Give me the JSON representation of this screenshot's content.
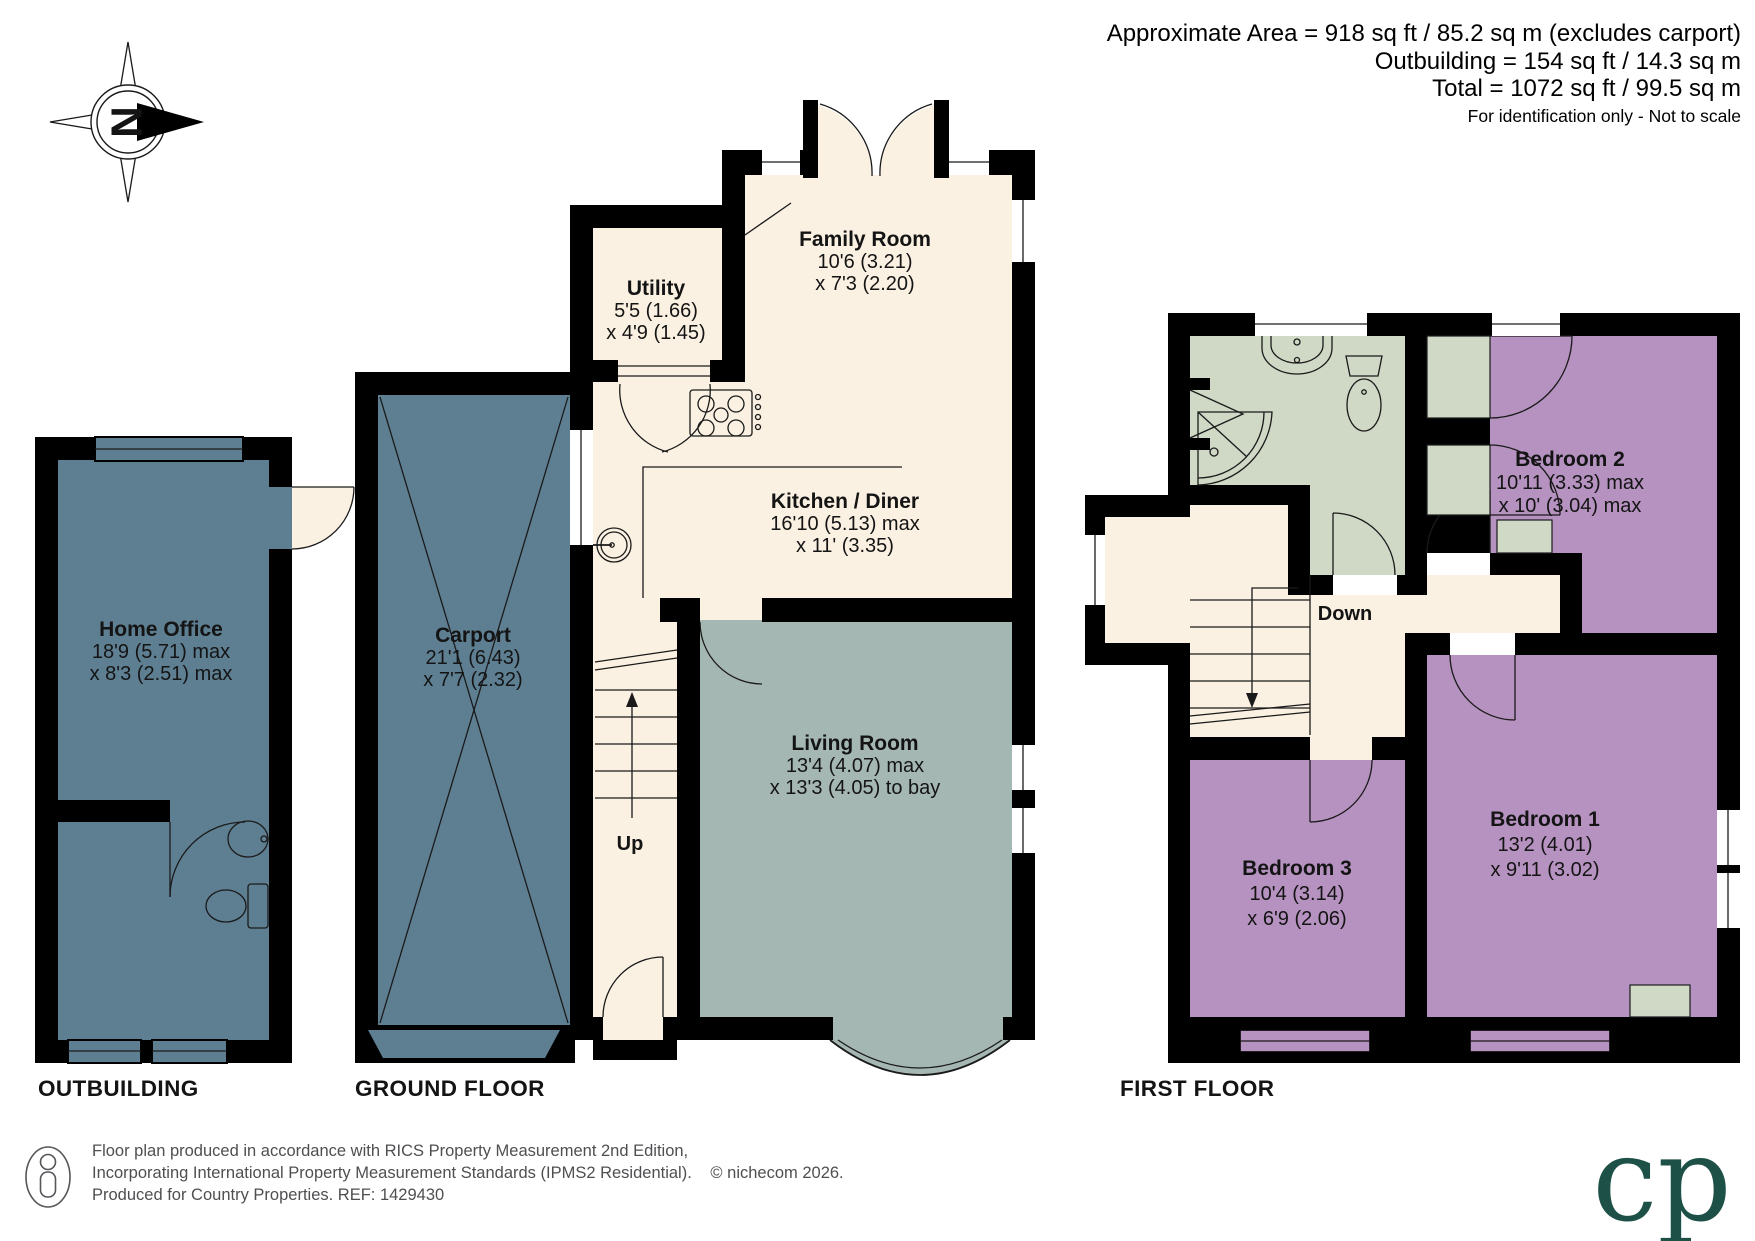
{
  "header": {
    "line1": "Approximate Area = 918 sq ft / 85.2 sq m (excludes carport)",
    "line2": "Outbuilding = 154 sq ft / 14.3 sq m",
    "line3": "Total = 1072 sq ft / 99.5 sq m",
    "note": "For identification only - Not to scale"
  },
  "compass": {
    "label": "N"
  },
  "outbuilding": {
    "floor_label": "OUTBUILDING",
    "home_office": {
      "name": "Home Office",
      "dim1": "18'9 (5.71) max",
      "dim2": "x 8'3 (2.51) max"
    }
  },
  "ground_floor": {
    "floor_label": "GROUND FLOOR",
    "family_room": {
      "name": "Family Room",
      "dim1": "10'6 (3.21)",
      "dim2": "x 7'3 (2.20)"
    },
    "utility": {
      "name": "Utility",
      "dim1": "5'5 (1.66)",
      "dim2": "x 4'9 (1.45)"
    },
    "kitchen_diner": {
      "name": "Kitchen / Diner",
      "dim1": "16'10 (5.13) max",
      "dim2": "x 11' (3.35)"
    },
    "living_room": {
      "name": "Living Room",
      "dim1": "13'4 (4.07) max",
      "dim2": "x 13'3 (4.05) to bay"
    },
    "carport": {
      "name": "Carport",
      "dim1": "21'1 (6.43)",
      "dim2": "x 7'7 (2.32)"
    },
    "stairs": "Up"
  },
  "first_floor": {
    "floor_label": "FIRST FLOOR",
    "bedroom1": {
      "name": "Bedroom 1",
      "dim1": "13'2 (4.01)",
      "dim2": "x 9'11 (3.02)"
    },
    "bedroom2": {
      "name": "Bedroom 2",
      "dim1": "10'11 (3.33) max",
      "dim2": "x 10' (3.04) max"
    },
    "bedroom3": {
      "name": "Bedroom 3",
      "dim1": "10'4 (3.14)",
      "dim2": "x 6'9 (2.06)"
    },
    "stairs": "Down"
  },
  "footer": {
    "line1": "Floor plan produced in accordance with RICS Property Measurement 2nd Edition,",
    "line2": "Incorporating International Property Measurement Standards (IPMS2 Residential).",
    "copyright": "© nichecom 2026.",
    "line3": "Produced for Country Properties.   REF: 1429430",
    "logo": "cp"
  },
  "colors": {
    "cream": "#fbf1e2",
    "steel_blue": "#5e7f92",
    "living_gray": "#a5b7b3",
    "mauve": "#b592bf",
    "sage": "#d0d8c6",
    "wall": "#000000",
    "logo_green": "#1d5147"
  }
}
